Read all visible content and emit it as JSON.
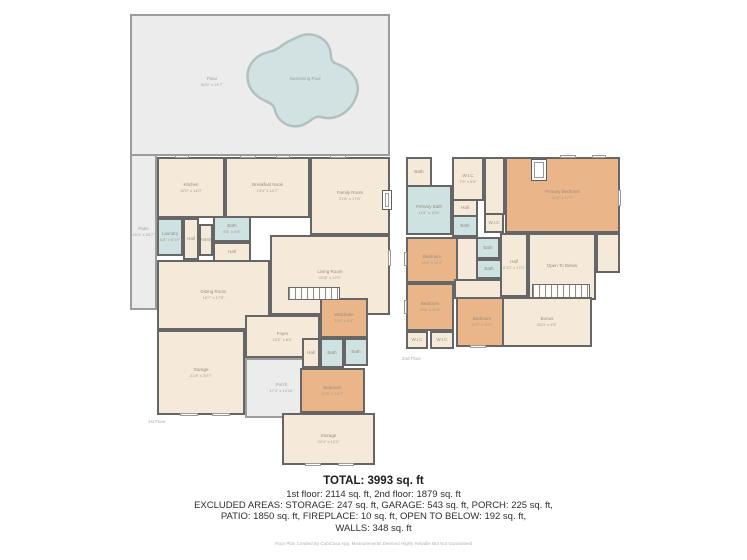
{
  "colors": {
    "wall": "#666666",
    "floor_cream": "#f5ead9",
    "room_orange": "#eab588",
    "room_blue": "#cfe2e2",
    "patio_gray": "#ececec",
    "pool_blue": "#d2e2e3"
  },
  "floor1": {
    "caption": "1st Floor",
    "rooms": {
      "patio_main": {
        "name": "Patio",
        "dims": "50'0\" x 24'7\""
      },
      "pool": {
        "name": "Swimming Pool",
        "dims": ""
      },
      "patio_side": {
        "name": "Patio",
        "dims": "10'4\" x 20'7\""
      },
      "kitchen": {
        "name": "Kitchen",
        "dims": "16'0\" x 14'0\""
      },
      "breakfast": {
        "name": "Breakfast Nook",
        "dims": "13'4\" x 10'7\""
      },
      "family": {
        "name": "Family Room",
        "dims": "21'8\" x 17'8\""
      },
      "laundry": {
        "name": "Laundry",
        "dims": "6'8\" x 6'10\""
      },
      "hall_a": {
        "name": "Hall",
        "dims": "4'7\" x 7'8\""
      },
      "pantry": {
        "name": "Pantry",
        "dims": ""
      },
      "bath_a": {
        "name": "Bath",
        "dims": "6'8\" x 5'8\""
      },
      "hall_b": {
        "name": "Hall",
        "dims": "6'2\" x 5'10\""
      },
      "dining": {
        "name": "Dining Room",
        "dims": "16'7\" x 17'5\""
      },
      "living": {
        "name": "Living Room",
        "dims": "22'8\" x 17'0\""
      },
      "foyer": {
        "name": "Foyer",
        "dims": "16'0\" x 8'0\""
      },
      "garage": {
        "name": "Garage",
        "dims": "21'8\" x 20'7\""
      },
      "porch": {
        "name": "Porch",
        "dims": "17'4\" x 13'10\""
      },
      "wardrobe": {
        "name": "Wardrobe",
        "dims": "11'4\" x 8'6\""
      },
      "hall_c": {
        "name": "Hall",
        "dims": ""
      },
      "bath_b": {
        "name": "Bath",
        "dims": "5'8\" x 6'0\""
      },
      "bath_c": {
        "name": "Bath",
        "dims": "5'4\" x 5'8\""
      },
      "bedroom1": {
        "name": "Bedroom",
        "dims": "13'6\" x 13'7\""
      },
      "storage": {
        "name": "Storage",
        "dims": "24'4\" x 12'3\""
      }
    }
  },
  "floor2": {
    "caption": "2nd Floor",
    "rooms": {
      "bath_d": {
        "name": "Bath",
        "dims": "8'0\" x 4'0\""
      },
      "primary_bath": {
        "name": "Primary Bath",
        "dims": "11'8\" x 10'6\""
      },
      "wic_a": {
        "name": "W.I.C",
        "dims": "7'0\" x 8'8\""
      },
      "hall_d": {
        "name": "Hall",
        "dims": "6'8\" x 4'0\""
      },
      "bath_e": {
        "name": "Bath",
        "dims": "7'8\" x 5'8\""
      },
      "wic_b": {
        "name": "W.I.C",
        "dims": ""
      },
      "primary_bedroom": {
        "name": "Primary Bedroom",
        "dims": "20'0\" x 17'0\""
      },
      "open_below": {
        "name": "Open To Below",
        "dims": ""
      },
      "bedroom2": {
        "name": "Bedroom",
        "dims": "13'6\" x 11'0\""
      },
      "bath_f": {
        "name": "Bath",
        "dims": "8'0\" x 5'4\""
      },
      "bath_g": {
        "name": "Bath",
        "dims": "7'4\" x 5'4\""
      },
      "hall_e": {
        "name": "Hall",
        "dims": "6'10\" x 17'0\""
      },
      "bedroom3": {
        "name": "Bedroom",
        "dims": "11'8\" x 11'4\""
      },
      "bedroom4": {
        "name": "Bedroom",
        "dims": "12'0\" x 12'0\""
      },
      "wic_c": {
        "name": "W.I.C",
        "dims": "6'0\" x 4'0\""
      },
      "wic_d": {
        "name": "W.I.C",
        "dims": "6'0\" x 4'0\""
      },
      "bonus": {
        "name": "Bonus",
        "dims": "26'0\" x 6'8\""
      }
    }
  },
  "summary": {
    "total": "TOTAL: 3993 sq. ft",
    "floors_line": "1st floor: 2114 sq. ft, 2nd floor: 1879 sq. ft",
    "excluded_line1": "EXCLUDED AREAS: STORAGE: 247 sq. ft, GARAGE: 543 sq. ft, PORCH: 225 sq. ft,",
    "excluded_line2": "PATIO: 1850 sq. ft, FIREPLACE: 10 sq. ft, OPEN TO BELOW: 192 sq. ft,",
    "excluded_line3": "WALLS: 348 sq. ft"
  },
  "footer": {
    "disclaimer": "Floor Plan Created By CubiCasa App, Measurements Deemed Highly Reliable But Not Guaranteed"
  }
}
